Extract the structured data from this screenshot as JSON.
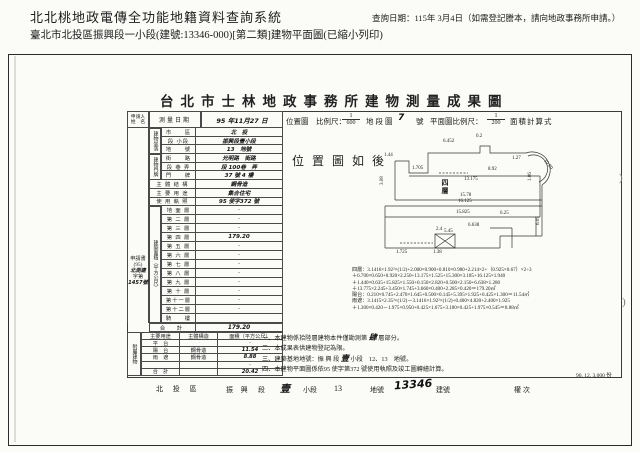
{
  "header": {
    "system_title": "北北桃地政電傳全功能地籍資料查詢系統",
    "query_date": "查詢日期：115年 3月4日（如需登記謄本，請向地政事務所申請。）",
    "subtitle": "臺北市北投區振興段一小段(建號:13346-000)[第二類]建物平面圖(已縮小列印)"
  },
  "sheet": {
    "title": "台北市士林地政事務所建物測量成果圖",
    "scale_row": {
      "survey_label": "測量日期",
      "survey_value": "95 年11月27 日",
      "loc_label": "位置圖　比例尺：",
      "loc_num": "1",
      "loc_den": "600",
      "district_label": "地段圖",
      "district_no": "7",
      "district_unit": "號",
      "plan_label": "平面圖比例尺：",
      "plan_num": "1",
      "plan_den": "200",
      "calc_label": "面積計算式"
    },
    "applicant_header_1": "申請人",
    "applicant_header_2": "姓　名",
    "applicant_note": [
      {
        "t": "申請書"
      },
      {
        "t": "(95)"
      },
      {
        "t": "北測建",
        "h": true
      },
      {
        "t": "字第"
      },
      {
        "t": "1457號",
        "h": true
      }
    ],
    "basic_rows": [
      {
        "label": "市　　區",
        "value": "北　投",
        "h": true
      },
      {
        "label": "段 小段",
        "value": "振興段壹小段",
        "h": true
      },
      {
        "label": "地　　號",
        "value": "13　地號",
        "h": true
      },
      {
        "label": "街　　路",
        "value": "光明路　街路",
        "h": true
      },
      {
        "label": "段 巷 弄",
        "value": "段 100巷　弄",
        "h": true
      },
      {
        "label": "門　　牌",
        "value": "37 號 4 樓",
        "h": true
      },
      {
        "label": "主 體 結 構",
        "value": "鋼骨造",
        "h": true,
        "wide": true
      },
      {
        "label": "主 要 用 途",
        "value": "集合住宅",
        "h": true,
        "wide": true
      },
      {
        "label": "使 用 執 照",
        "value": "95 使字372 號",
        "h": true,
        "wide": true
      }
    ],
    "group_site": "建物坐落",
    "group_door": "建物門牌",
    "floors_group_label": "建築面積（平方公尺）",
    "floors": [
      {
        "label": "地 面 層",
        "value": "-"
      },
      {
        "label": "第 二 層",
        "value": "-"
      },
      {
        "label": "第 三 層",
        "value": "-"
      },
      {
        "label": "第 四 層",
        "value": "179.20",
        "h": true
      },
      {
        "label": "第 五 層",
        "value": "-"
      },
      {
        "label": "第 六 層",
        "value": "-"
      },
      {
        "label": "第 七 層",
        "value": "-"
      },
      {
        "label": "第 八 層",
        "value": "-"
      },
      {
        "label": "第 九 層",
        "value": "-"
      },
      {
        "label": "第 十 層",
        "value": "-"
      },
      {
        "label": "第十一層",
        "value": "-"
      },
      {
        "label": "第十二層",
        "value": "-"
      },
      {
        "label": "騎　　樓",
        "value": ""
      }
    ],
    "total_row": {
      "label": "合　計",
      "value": "179.20"
    },
    "annex": {
      "group_label": "附屬建物",
      "headers": {
        "use": "主要用途",
        "structure": "主體構造",
        "area": "面積（平方公尺）"
      },
      "rows": [
        {
          "use": "平　台",
          "structure": "",
          "area": "-"
        },
        {
          "use": "陽　台",
          "structure": "鋼骨造",
          "area": "11.54",
          "h": true
        },
        {
          "use": "雨　遮",
          "structure": "鋼骨造",
          "area": "8.88",
          "h": true
        },
        {
          "use": "",
          "structure": "",
          "area": "-"
        },
        {
          "use": "合　計",
          "structure": "",
          "area": "20.42",
          "h": true
        }
      ]
    }
  },
  "plan": {
    "caption": "位置圖如後",
    "floor_label": "四層",
    "dims": [
      {
        "v": "1.44",
        "x": 44,
        "y": 20
      },
      {
        "v": "3.08",
        "x": 40,
        "y": 52,
        "rot": -90
      },
      {
        "v": "1.705",
        "x": 72,
        "y": 33
      },
      {
        "v": "6.452",
        "x": 103,
        "y": 6
      },
      {
        "v": "0.2",
        "x": 136,
        "y": 1
      },
      {
        "v": "8.92",
        "x": 148,
        "y": 34
      },
      {
        "v": "1.27",
        "x": 172,
        "y": 23
      },
      {
        "v": "10.80",
        "x": 206,
        "y": 26,
        "rot": 50
      },
      {
        "v": "13.175",
        "x": 124,
        "y": 44
      },
      {
        "v": "15.78",
        "x": 120,
        "y": 60
      },
      {
        "v": "16.125",
        "x": 118,
        "y": 66
      },
      {
        "v": "15.825",
        "x": 116,
        "y": 77
      },
      {
        "v": "6.25",
        "x": 160,
        "y": 78
      },
      {
        "v": "6.638",
        "x": 128,
        "y": 90
      },
      {
        "v": "5.45",
        "x": 104,
        "y": 96
      },
      {
        "v": "6.05",
        "x": 196,
        "y": 92,
        "rot": -90
      },
      {
        "v": "2.4",
        "x": 96,
        "y": 94
      },
      {
        "v": "1.38",
        "x": 93,
        "y": 117
      },
      {
        "v": "1.725",
        "x": 56,
        "y": 117
      },
      {
        "v": "1.06",
        "x": 188,
        "y": 48,
        "rot": -90
      }
    ]
  },
  "formulas": [
    "四層：3.1416×1.92²×(1/2)+2.000×0.900+0.810×0.980+2.214×2+（0.925×0.67）×2÷3",
    "＋6.700×0.650+0.920×2.250+13.175×1.525+15.300×3.185+16.125×1.940",
    "＋1.440×0.635+15.825×1.550+0.150×2.820+0.500×2.150+6.638×1.280",
    "＋13.775×2.245+3.450×1.745+3.660×0.400+2.285×0.420＝179.20㎡",
    "陽台：0.210×0.745+2.470×1.645+0.500×0.145+5.395×1.925+0.425×1.300＝11.54㎡",
    "雨遮：3.1415×2.35²×(1/2)－3.1416×1.92²×(1/2)+0.400×4.820+2.400×1.925",
    "＋1.300×0.420－1.975×0.950+0.425×1.675+3.180×0.425+1.975×0.545＝8.88㎡"
  ],
  "notes": [
    {
      "pre": "一、本建物係拾陸層建物本件僅勘測第 ",
      "hand": "肆",
      "post": " 層部分。"
    },
    {
      "pre": "二、本成果表供建物登記為限。",
      "hand": "",
      "post": ""
    },
    {
      "pre": "三、建築基地地號：振 興 段 ",
      "hand": "壹",
      "post": " 小段　12、13　地號。"
    },
    {
      "pre": "四、本建物平面圖係依95 使字第372 號使用執照及竣工圖轉繪計算。",
      "hand": "",
      "post": ""
    }
  ],
  "footer": {
    "district": "北 投 區",
    "section": "振 興",
    "duan": "段",
    "sub_hand": "壹",
    "subsection": "小段",
    "land_no": "13",
    "land_unit": "地號",
    "bldg_no": "13346",
    "bldg_unit": "建號",
    "right_label": "權次",
    "print_info": "90. 12. 3,000 份"
  },
  "artifacts": {
    "a1": ")",
    "a2": ")"
  }
}
